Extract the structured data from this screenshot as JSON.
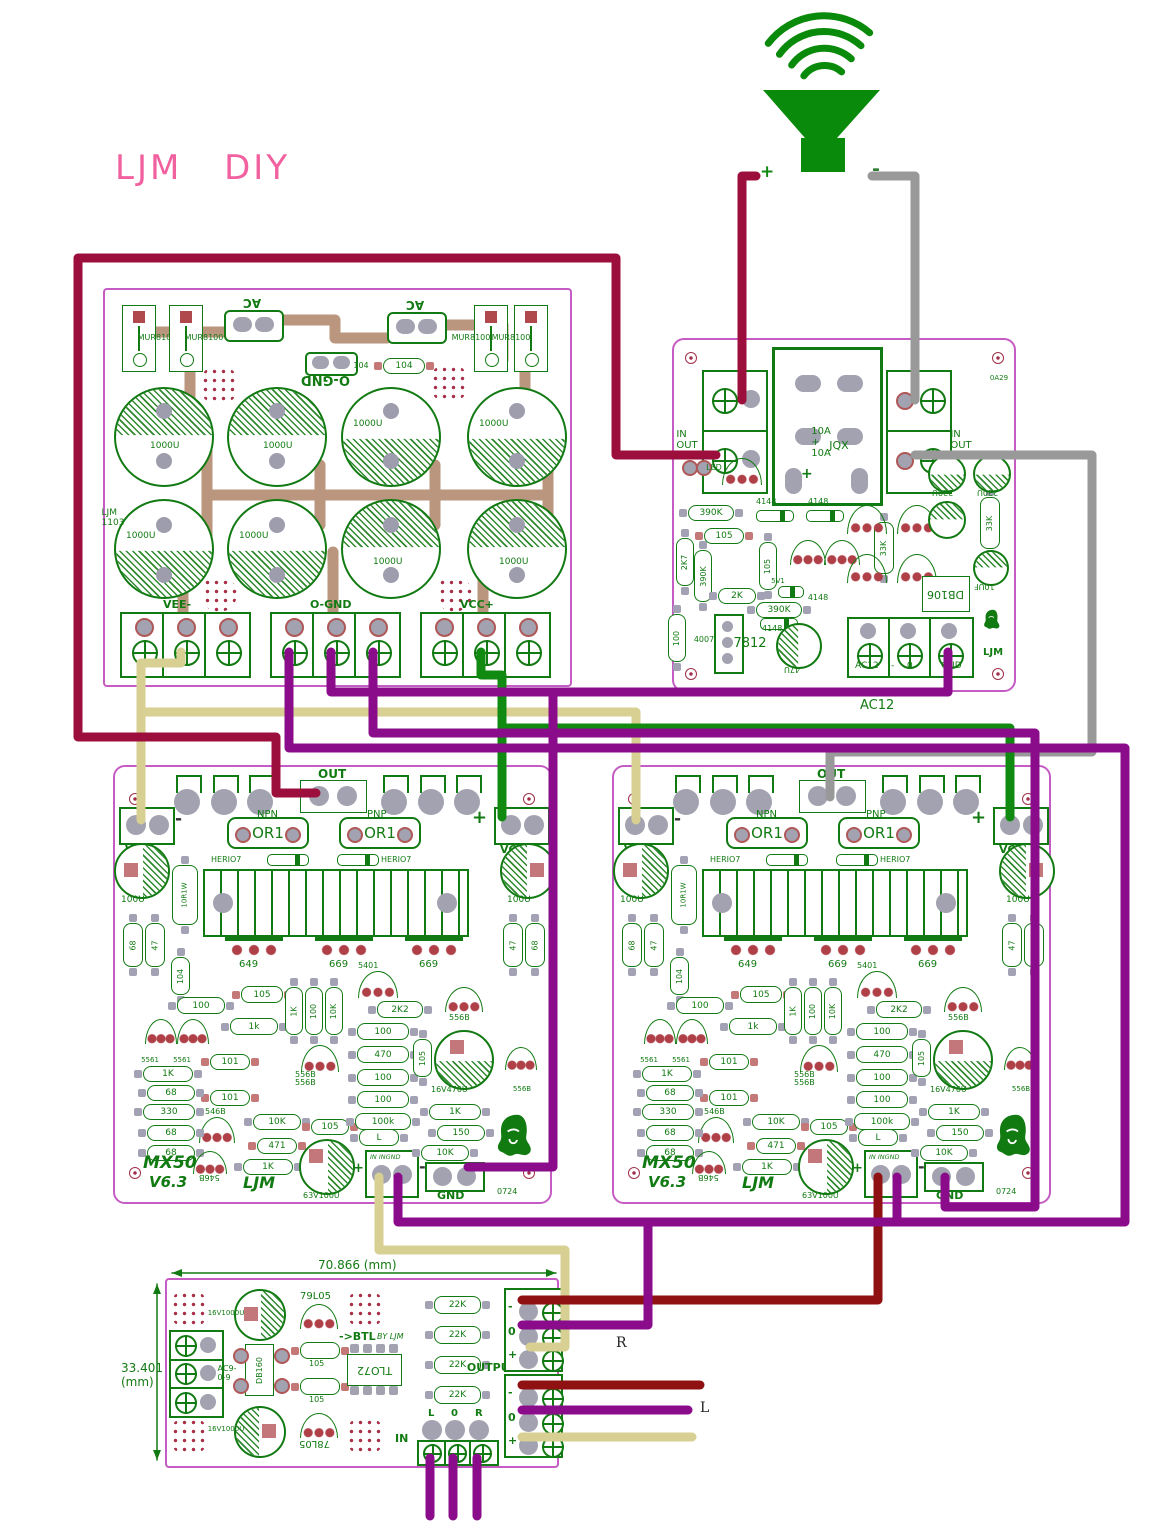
{
  "header": {
    "brand": "LJM",
    "diy": "DIY"
  },
  "speaker": {
    "plus": "+",
    "minus": "-"
  },
  "wire_labels": {
    "right_channel": "R",
    "left_channel": "L",
    "ac12": "AC12"
  },
  "psu": {
    "mur8100": "MUR8100",
    "ac": "AC",
    "ognd_top": "O-GND",
    "c104": "104",
    "cap_1000u": "1000U",
    "side_text": "LJM 1103",
    "term_vee": "VEE-",
    "term_ognd": "O-GND",
    "term_vcc": "VCC+"
  },
  "protection": {
    "in_out": "IN  OUT",
    "relay_rating": "10A + 10A",
    "relay_model": "JQX",
    "plus": "+",
    "led": "LED",
    "r390k": "390K",
    "r33k": "33K",
    "c220u": "220U",
    "c10uf": "10UF",
    "r2k7": "2K7",
    "c105": "105",
    "d4148": "4148",
    "z5v1": "5V1",
    "r2k": "2K",
    "reg7812": "7812",
    "d4007": "4007",
    "c47u": "47U",
    "r100": "100",
    "db106": "DB106",
    "ljm": "LJM",
    "code": "0A29",
    "term_ac12": "AC12",
    "term_dash": "-",
    "term_0": "0",
    "term_gnd": "GND"
  },
  "amp": {
    "out": "OUT",
    "npn": "NPN",
    "pnp": "PNP",
    "or1": "OR1",
    "her107": "HERIO7",
    "vee": "VEE",
    "vcc": "VCC",
    "plus": "+",
    "minus": "-",
    "q649": "649",
    "q669": "669",
    "q5401": "5401",
    "cap_100u": "100U",
    "r_10r1w": "10R1W",
    "r68": "68",
    "r47": "47",
    "c104": "104",
    "r100": "100",
    "c105": "105",
    "r1k_lower": "1k",
    "r1k": "1K",
    "r10k": "10K",
    "q5561": "5561",
    "r101": "101",
    "r330": "330",
    "q546b": "546B",
    "q556b": "556B",
    "r471": "471",
    "cap_63v": "63V100U",
    "link": "L",
    "in_ingnd": "IN  INGND",
    "gnd": "GND",
    "code": "0724",
    "r2k2": "2K2",
    "r470": "470",
    "r100k": "100k",
    "cap_16v470u": "16V470U",
    "r150": "150",
    "model": "MX50",
    "version": "V6.3",
    "ljm": "LJM"
  },
  "input_board": {
    "dim_width": "70.866 (mm)",
    "dim_height": "33.401 (mm)",
    "cap_16v1000u": "16V1000U",
    "reg_79l05": "79L05",
    "reg_78l05": "78L05",
    "term_ac909": "AC9-0-9",
    "db160": "DB160",
    "c105": "105",
    "btl": "->BTL",
    "by_ljm": "BY LJM",
    "ic_tl072": "TLO72",
    "r22k": "22K",
    "output": "OUTPUT",
    "pin_minus": "-",
    "pin_zero": "0",
    "pin_plus": "+",
    "ch_l": "L",
    "ch_0": "0",
    "ch_r": "R",
    "in": "IN"
  }
}
